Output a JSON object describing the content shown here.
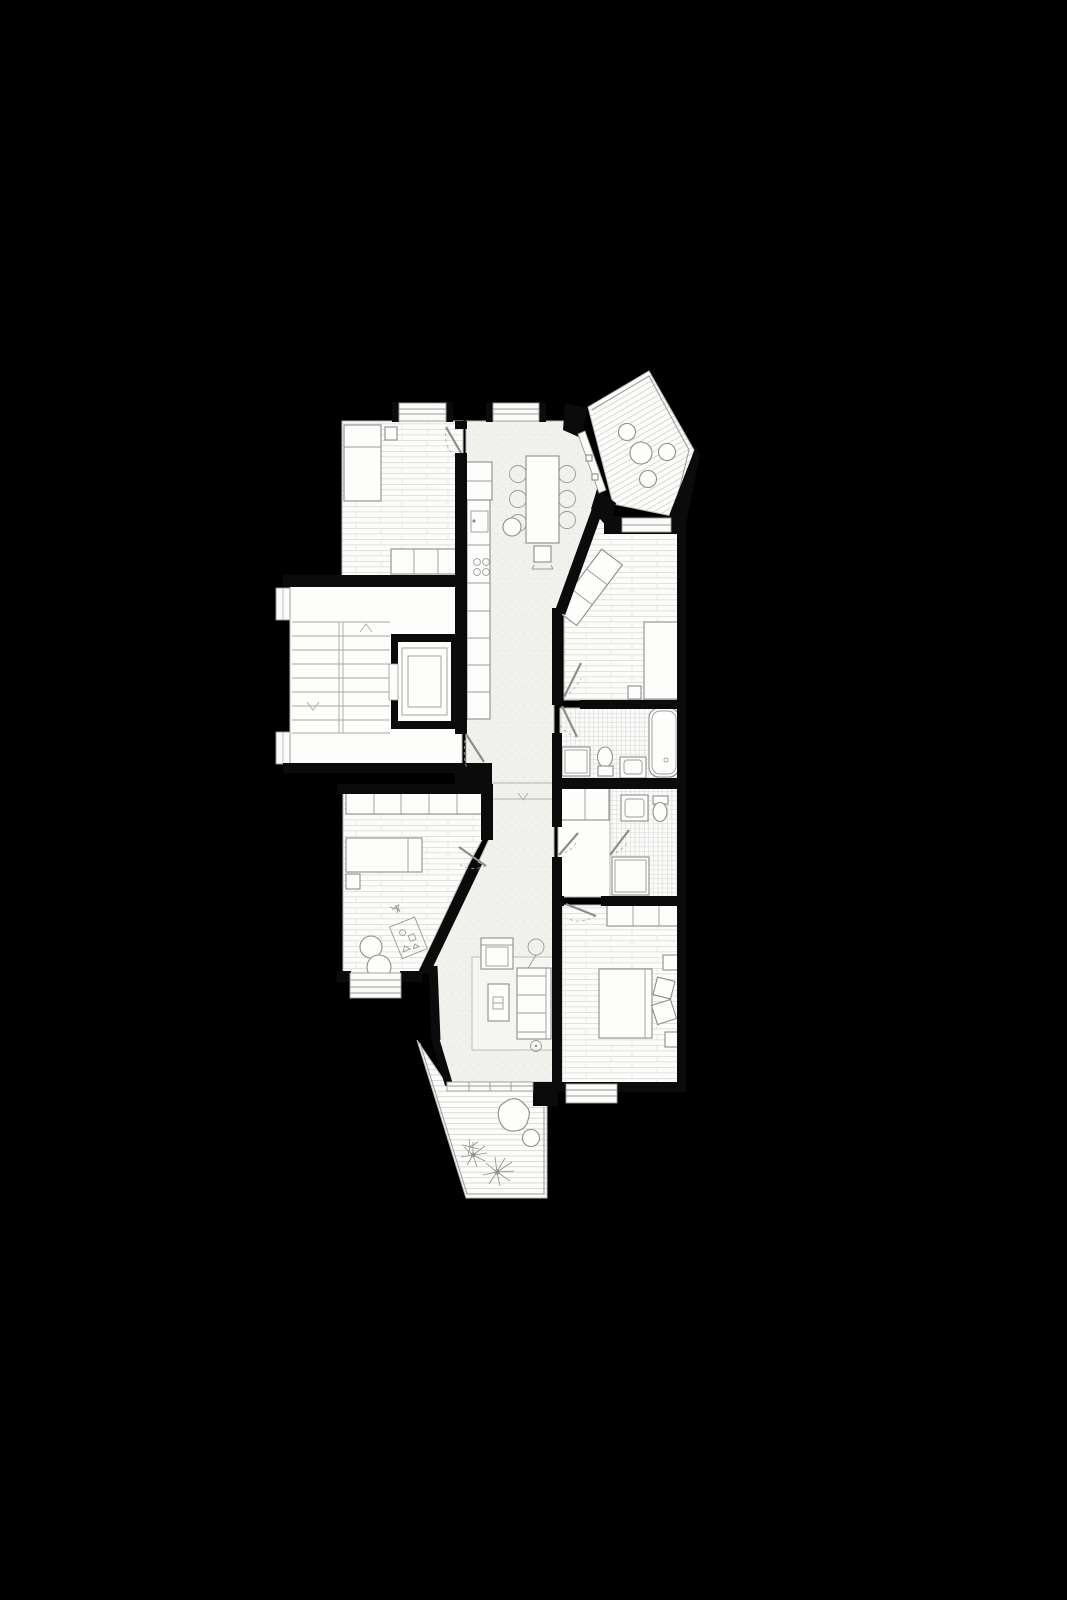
{
  "document": {
    "title": "Apartment floor plan — black background architectural drawing",
    "description": "Top-down monochrome line-drawing floor plan of a multi-room apartment floating on a solid black background. No text labels, dimensions or annotations are visible anywhere in the image.",
    "type": "architectural-floor-plan",
    "view": "top-down plan",
    "visible_text": "none"
  },
  "colors": {
    "background": "#000000",
    "room_floor": "#fdfdfc",
    "open_plan_floor_speckle": "#f1f1ee",
    "wall_fill": "#0b0b0b",
    "line_work": "#8d8d8a",
    "plank_line": "#d8d8d4",
    "tile_line": "#cfcfcc"
  },
  "rooms": [
    {
      "id": "bedroom-1",
      "name": "Bedroom (top left)",
      "floor": "horizontal wood planks",
      "furniture": [
        "double-bed",
        "nightstand",
        "3-door wardrobe"
      ],
      "openings": [
        "top window bay",
        "door to hall"
      ]
    },
    {
      "id": "stairwell",
      "name": "Common stairwell with landing",
      "floor": "plain",
      "furniture": [
        "two stair flights with up and down arrows",
        "elevator car"
      ],
      "openings": [
        "two west facade windows",
        "apartment entrance door"
      ]
    },
    {
      "id": "kids-room",
      "name": "Kids room / study (middle left)",
      "floor": "horizontal wood planks",
      "furniture": [
        "5-door wardrobe",
        "single bed",
        "nightstand",
        "toy",
        "play rug",
        "two poufs"
      ],
      "openings": [
        "south bay window",
        "door to hall"
      ]
    },
    {
      "id": "open-plan",
      "name": "Entrance hall + kitchen + dining + living room (open plan)",
      "floor": "light speckled screed",
      "furniture": [
        "tall fridge unit",
        "kitchen counter with sink and 4-burner cooktop",
        "dining table",
        "6 dining chairs",
        "round chair",
        "high chair",
        "rug",
        "armchair",
        "floor lamp",
        "sofa",
        "coffee table",
        "potted plant"
      ],
      "openings": [
        "top window bay",
        "entrance door from stairwell",
        "sliding door to terrace",
        "step threshold with chevron"
      ]
    },
    {
      "id": "balcony",
      "name": "Angled balcony (top right)",
      "floor": "diagonal deck planks",
      "furniture": [
        "round bistro table",
        "3 round chairs"
      ],
      "openings": [
        "sliding door from hall"
      ]
    },
    {
      "id": "bedroom-2",
      "name": "Bedroom (middle right)",
      "floor": "horizontal wood planks",
      "furniture": [
        "angled 3-seat sofa",
        "single bed",
        "nightstand"
      ],
      "openings": [
        "north window to balcony",
        "door to hall"
      ]
    },
    {
      "id": "bathroom",
      "name": "Bathroom",
      "floor": "square tiles",
      "furniture": [
        "bathtub",
        "toilet",
        "vanity sink",
        "shower tray"
      ],
      "openings": [
        "door from hall"
      ]
    },
    {
      "id": "shower-wc",
      "name": "Hallway closet + shower WC",
      "floor": "tiles right / plain left",
      "furniture": [
        "2-door closet",
        "sink",
        "toilet",
        "shower tray"
      ],
      "openings": [
        "door from hall",
        "inner door"
      ]
    },
    {
      "id": "bedroom-3",
      "name": "Bedroom (bottom right)",
      "floor": "horizontal wood planks",
      "furniture": [
        "3-door wardrobe",
        "double bed",
        "two pillows",
        "two nightstands"
      ],
      "openings": [
        "door from hall",
        "south window bay"
      ]
    },
    {
      "id": "terrace",
      "name": "Terrace (bottom)",
      "floor": "horizontal deck planks",
      "furniture": [
        "beanbag lounge chair",
        "round side table",
        "two plants"
      ],
      "openings": [
        "sliding door from living room"
      ],
      "detail": "railing along west, south and east edges"
    }
  ],
  "counts": {
    "rooms_enclosed": 7,
    "outdoor_areas": 2,
    "dining_chairs": 6,
    "balcony_chairs": 3
  }
}
